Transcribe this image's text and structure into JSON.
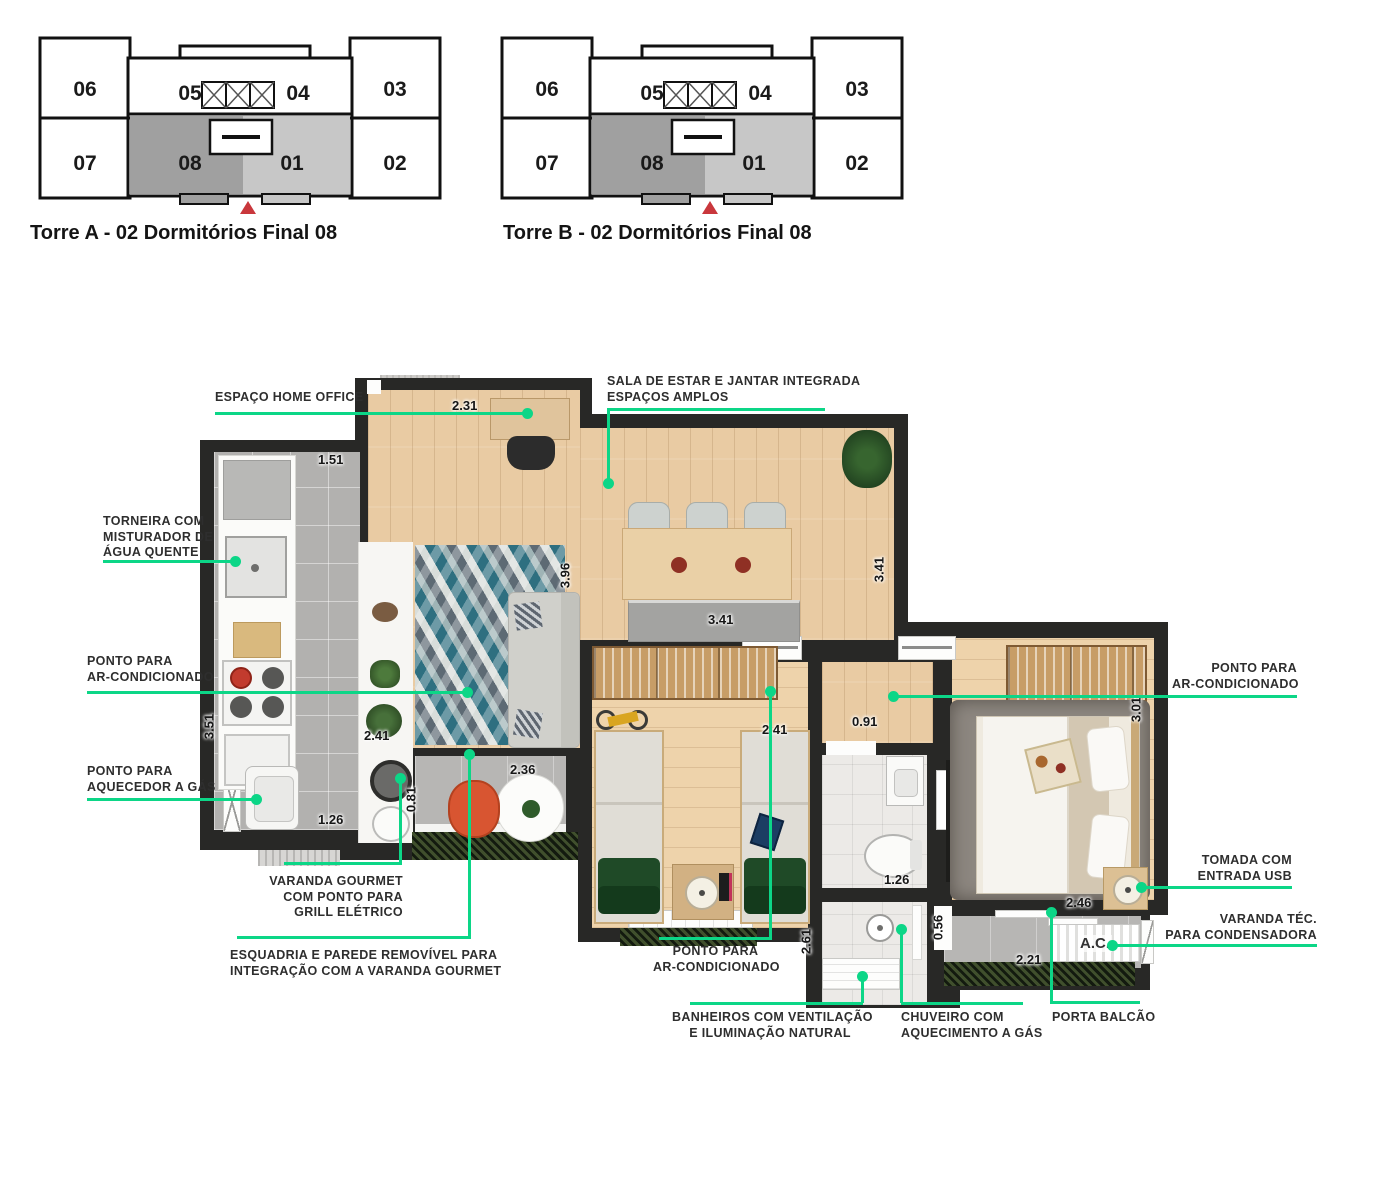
{
  "colors": {
    "accent_green": "#0cd687",
    "wall_dark": "#282826",
    "wood": "#e9cba3",
    "kitchen_tile": "#b2b1af",
    "marker_red": "#c9373c",
    "unit08_fill": "#a0a0a0",
    "unit01_fill": "#c7c7c7"
  },
  "keyplans": [
    {
      "id": "torre-a",
      "title": "Torre A - 02 Dormitórios Final 08",
      "units": [
        "06",
        "05",
        "04",
        "03",
        "07",
        "08",
        "01",
        "02"
      ]
    },
    {
      "id": "torre-b",
      "title": "Torre B - 02 Dormitórios Final 08",
      "units": [
        "06",
        "05",
        "04",
        "03",
        "07",
        "08",
        "01",
        "02"
      ]
    }
  ],
  "plan": {
    "ac_label": "A.C.",
    "annotations": {
      "home_office": {
        "l1": "ESPAÇO HOME OFFICE"
      },
      "sala": {
        "l1": "SALA DE ESTAR E JANTAR INTEGRADA",
        "l2": "ESPAÇOS AMPLOS"
      },
      "torneira": {
        "l1": "TORNEIRA COM",
        "l2": "MISTURADOR DE",
        "l3": "ÁGUA QUENTE"
      },
      "ar_left": {
        "l1": "PONTO PARA",
        "l2": "AR-CONDICIONADO"
      },
      "aquecedor": {
        "l1": "PONTO PARA",
        "l2": "AQUECEDOR A GÁS"
      },
      "varanda_gourmet": {
        "l1": "VARANDA GOURMET",
        "l2": "COM PONTO PARA",
        "l3": "GRILL ELÉTRICO"
      },
      "esquadria": {
        "l1": "ESQUADRIA E PAREDE REMOVÍVEL PARA",
        "l2": "INTEGRAÇÃO COM A VARANDA GOURMET"
      },
      "ar_mid": {
        "l1": "PONTO PARA",
        "l2": "AR-CONDICIONADO"
      },
      "banheiros": {
        "l1": "BANHEIROS COM VENTILAÇÃO",
        "l2": "E ILUMINAÇÃO NATURAL"
      },
      "chuveiro": {
        "l1": "CHUVEIRO COM",
        "l2": "AQUECIMENTO A GÁS"
      },
      "porta_balcao": {
        "l1": "PORTA BALCÃO"
      },
      "ar_right": {
        "l1": "PONTO PARA",
        "l2": "AR-CONDICIONADO"
      },
      "tomada": {
        "l1": "TOMADA COM",
        "l2": "ENTRADA USB"
      },
      "varanda_tec": {
        "l1": "VARANDA TÉC.",
        "l2": "PARA CONDENSADORA"
      }
    },
    "dimensions": {
      "d_231": "2.31",
      "d_151": "1.51",
      "d_396": "3.96",
      "d_341a": "3.41",
      "d_341b": "3.41",
      "d_241a": "2.41",
      "d_236": "2.36",
      "d_081": "0.81",
      "d_351": "3.51",
      "d_126a": "1.26",
      "d_241b": "2.41",
      "d_091": "0.91",
      "d_301": "3.01",
      "d_126b": "1.26",
      "d_246": "2.46",
      "d_056": "0.56",
      "d_261": "2.61",
      "d_221": "2.21"
    }
  }
}
